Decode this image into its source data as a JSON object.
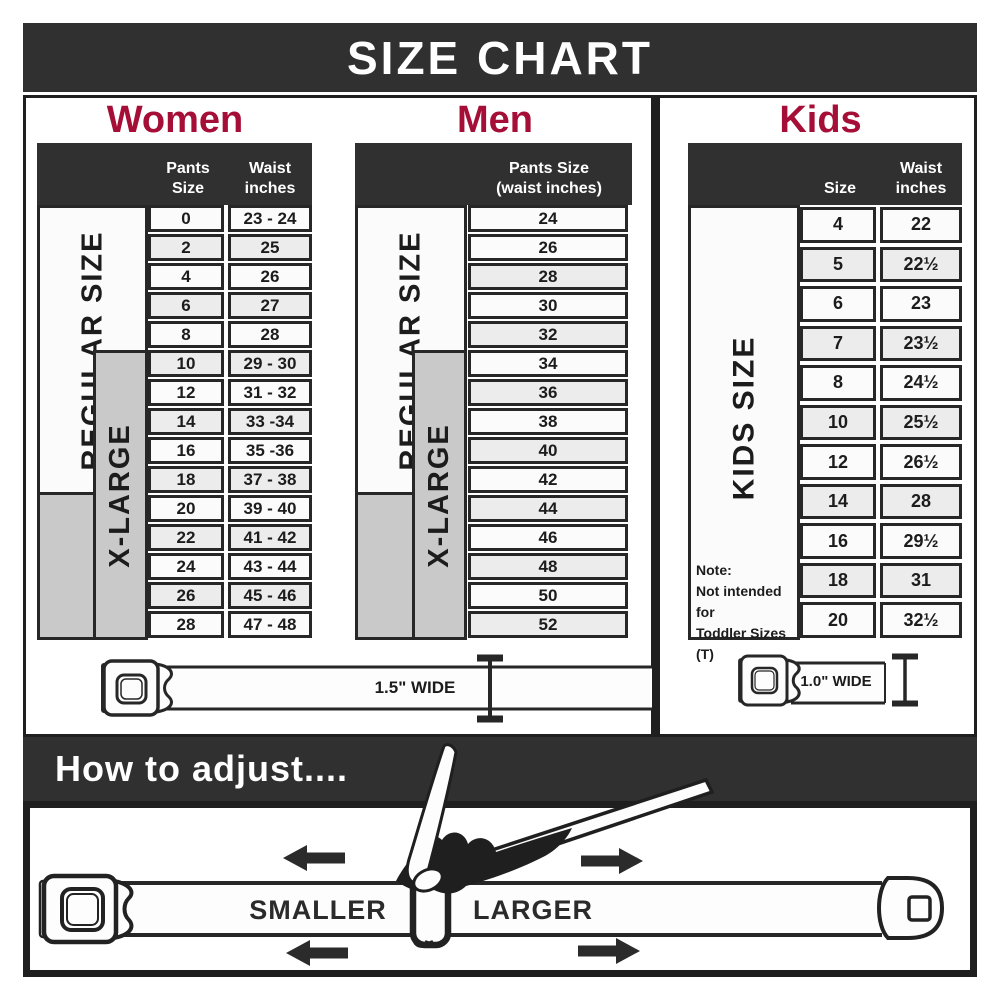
{
  "title": "SIZE CHART",
  "colors": {
    "accent": "#a50e36",
    "dark_band": "#303030",
    "row_alt": "#ececec",
    "xlarge_gray": "#c9c9c9",
    "line": "#272727"
  },
  "women": {
    "heading": "Women",
    "col1_header": "Pants Size",
    "col2_header": "Waist\ninches",
    "regular_label": "REGULAR SIZE",
    "xlarge_label": "X-LARGE",
    "belt_width": "1.5\" WIDE",
    "rows": [
      [
        "0",
        "23 - 24"
      ],
      [
        "2",
        "25"
      ],
      [
        "4",
        "26"
      ],
      [
        "6",
        "27"
      ],
      [
        "8",
        "28"
      ],
      [
        "10",
        "29 - 30"
      ],
      [
        "12",
        "31 - 32"
      ],
      [
        "14",
        "33 -34"
      ],
      [
        "16",
        "35 -36"
      ],
      [
        "18",
        "37 - 38"
      ],
      [
        "20",
        "39 - 40"
      ],
      [
        "22",
        "41 - 42"
      ],
      [
        "24",
        "43 - 44"
      ],
      [
        "26",
        "45 - 46"
      ],
      [
        "28",
        "47 - 48"
      ]
    ]
  },
  "men": {
    "heading": "Men",
    "col_header": "Pants Size\n(waist inches)",
    "regular_label": "REGULAR SIZE",
    "xlarge_label": "X-LARGE",
    "rows": [
      "24",
      "26",
      "28",
      "30",
      "32",
      "34",
      "36",
      "38",
      "40",
      "42",
      "44",
      "46",
      "48",
      "50",
      "52"
    ]
  },
  "kids": {
    "heading": "Kids",
    "col1_header": "Size",
    "col2_header": "Waist\ninches",
    "side_label": "KIDS SIZE",
    "belt_width": "1.0\" WIDE",
    "note_title": "Note:",
    "note_line1": "Not intended for",
    "note_line2": "Toddler Sizes (T)",
    "rows": [
      [
        "4",
        "22"
      ],
      [
        "5",
        "22½"
      ],
      [
        "6",
        "23"
      ],
      [
        "7",
        "23½"
      ],
      [
        "8",
        "24½"
      ],
      [
        "10",
        "25½"
      ],
      [
        "12",
        "26½"
      ],
      [
        "14",
        "28"
      ],
      [
        "16",
        "29½"
      ],
      [
        "18",
        "31"
      ],
      [
        "20",
        "32½"
      ]
    ]
  },
  "adjust": {
    "heading": "How to adjust....",
    "smaller": "SMALLER",
    "larger": "LARGER"
  }
}
